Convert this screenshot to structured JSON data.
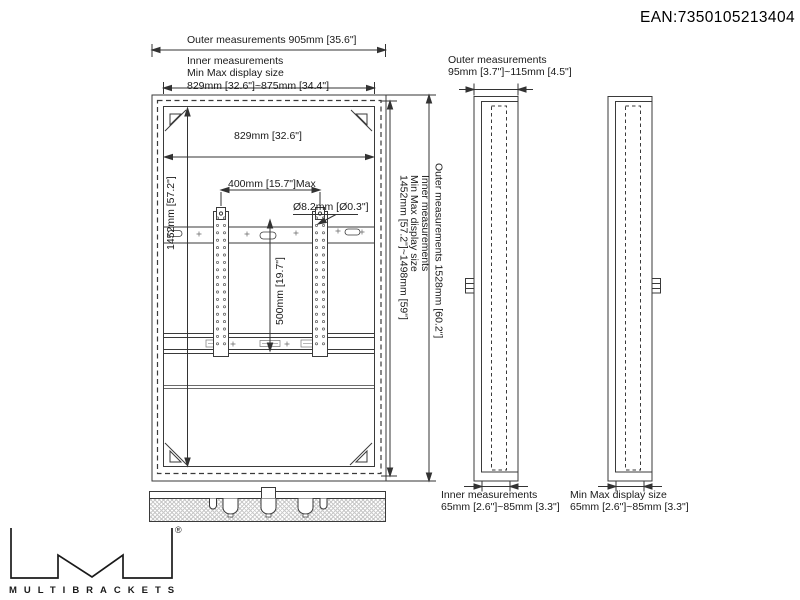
{
  "ean": "EAN:7350105213404",
  "front": {
    "outer_width": "Outer measurements 905mm [35.6\"]",
    "inner_width_l1": "Inner measurements",
    "inner_width_l2": "Min Max display size",
    "inner_width_l3": "829mm [32.6\"]~875mm [34.4\"]",
    "inner_width_dim": "829mm [32.6\"]",
    "height_dim": "1452mm [57.2\"]",
    "vesa_width_dim": "400mm [15.7\"]Max",
    "hole_dia": "Ø8.2mm [Ø0.3\"]",
    "vesa_height_dim": "500mm [19.7\"]",
    "inner_height_l1": "Inner measurements",
    "inner_height_l2": "Min Max display size",
    "inner_height_l3": "1452mm [57.2\"]~1498mm [59\"]",
    "outer_height": "Outer measurements 1528mm [60.2\"]"
  },
  "side": {
    "outer_l1": "Outer measurements",
    "outer_l2": "95mm [3.7\"]~115mm [4.5\"]",
    "inner_l1": "Inner measurements",
    "inner_l2": "65mm [2.6\"]~85mm [3.3\"]",
    "minmax_l1": "Min Max display size",
    "minmax_l2": "65mm [2.6\"]~85mm [3.3\"]"
  },
  "brand": {
    "name": "MULTIBRACKETS",
    "reg": "®"
  },
  "colors": {
    "line": "#3a3a3a",
    "text": "#1a1a1a"
  }
}
